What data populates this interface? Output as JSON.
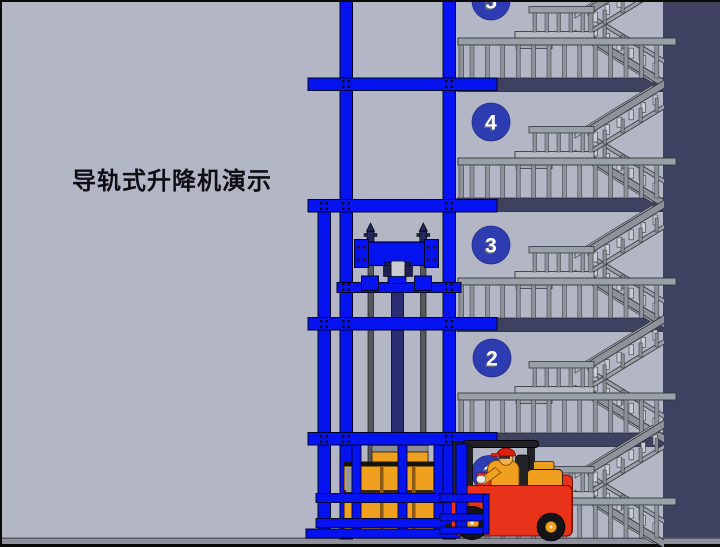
{
  "title": "导轨式升降机演示",
  "floors": [
    {
      "label": "5"
    },
    {
      "label": "4"
    },
    {
      "label": "3"
    },
    {
      "label": "2"
    },
    {
      "label": "1"
    }
  ],
  "colors": {
    "background": "#b3b6c5",
    "structure_blue": "#0513f0",
    "slab_navy": "#3e4160",
    "right_wall_navy": "#3e4160",
    "badge_blue": "#2e3cb2",
    "stair_gray": "#9aa0a8",
    "stair_light": "#c9ccd3",
    "cargo_orange": "#f0a01e",
    "forklift_red": "#e8321a",
    "cylinder_navy": "#2b2d72",
    "ground_gray": "#8f909c"
  }
}
